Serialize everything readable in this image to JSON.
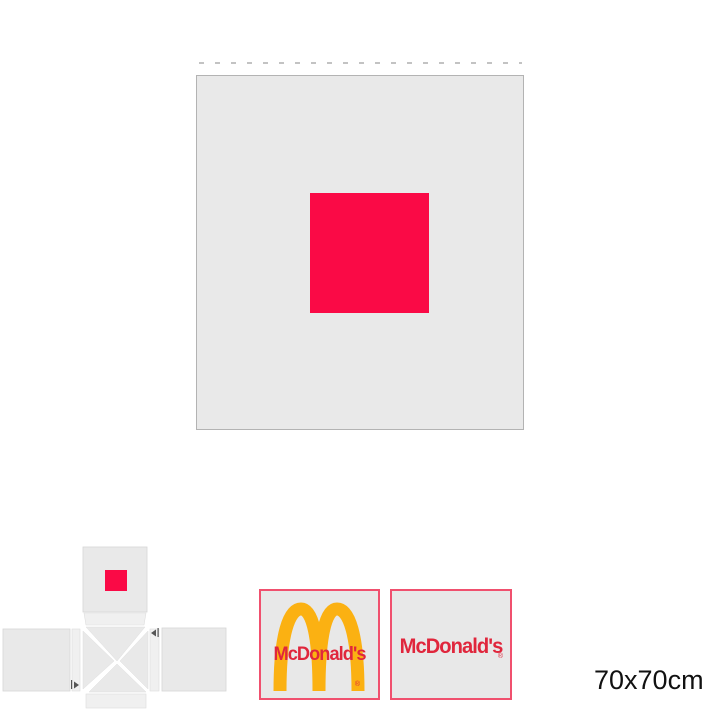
{
  "size_label": "70x70cm",
  "preview": {
    "description": "front panel of product with centered color block",
    "panel_fill": "#e9e9e9",
    "panel_border": "#b3b3b3",
    "fold_line_color": "#c3c3c3",
    "design_color": "#fa0a46"
  },
  "dieline": {
    "description": "unfolded product template with four side panels, flaps and folding wedges",
    "panel_fill": "#e9e9e9",
    "flap_fill": "#f0f0f0",
    "panel_stroke": "#d6d6d6",
    "design_color": "#fa0a46",
    "fold_arrow_color": "#555555"
  },
  "logo_options": [
    {
      "id": "arches-with-wordmark",
      "wordmark": "McDonald's",
      "registered_mark": "®",
      "arches_color": "#fbb112",
      "wordmark_color": "#e0263c",
      "border_color": "#f0506e",
      "fill": "#e8e8e8"
    },
    {
      "id": "wordmark-only",
      "wordmark": "McDonald's",
      "registered_mark": "®",
      "wordmark_color": "#e0263c",
      "border_color": "#f0506e",
      "fill": "#e8e8e8"
    }
  ]
}
